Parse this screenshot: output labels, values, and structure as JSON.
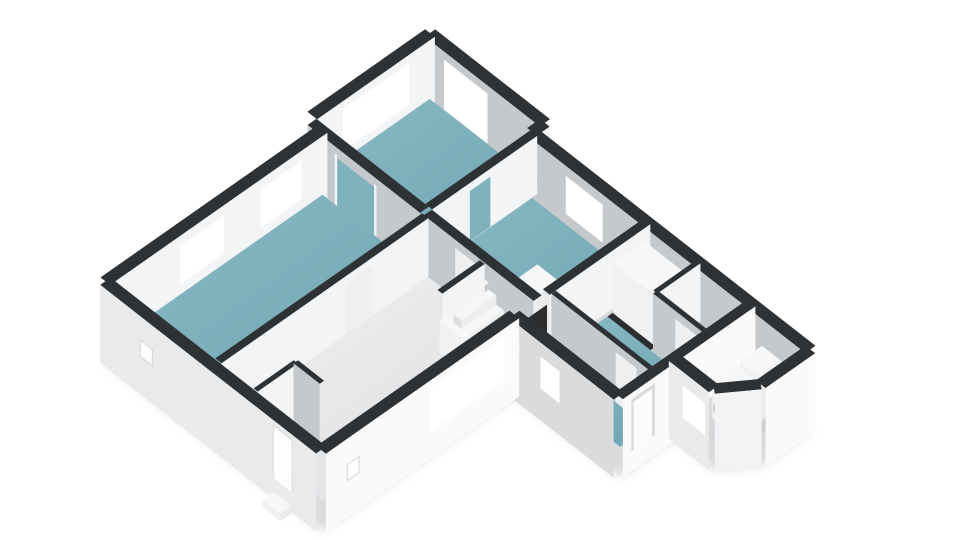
{
  "meta": {
    "title": "3D isometric floor plan, ground floor, no visible text",
    "background": "#ffffff",
    "view": "isometric-3d-floorplan"
  },
  "palette": {
    "band": "#2f3234",
    "intSW": "#c6c9cb",
    "intSE": "#f3f4f5",
    "extSW": "#e9eaec",
    "extSW2": "#d9dbdd",
    "extSE": "#fafafb",
    "chamfer": "#f2f3f5",
    "frame": "#ffffff",
    "glass": "#d8e7ec",
    "glassDoor": "#d2e2e8",
    "darkGap": "#2b2d2f",
    "doorgap": "#edeff0",
    "passage": "#7fb2bd",
    "tealA": "#8abac4",
    "tealB": "#6da5b2",
    "lightA": "#eff0f1",
    "lightB": "#dcdee1",
    "utilA": "#e9eaec",
    "utilB": "#c3c6ca",
    "boxTop": "#f6f7f8",
    "boxSW": "#f0f1f3",
    "boxSE": "#e8eaec",
    "stairTop": "#f5f6f7",
    "stairRiser": "#eceeef",
    "stairSide": "#dcdee0",
    "red": "#cb4334",
    "white": "#fcfdfd",
    "washerRing": "#c2c5c7",
    "washerFaceFill": "#eceef0",
    "washerHole": "#56595b",
    "shadow": "#8a9096"
  },
  "projection": {
    "ox": 430,
    "oy": 33,
    "ux": 34.8,
    "uy": 27.2,
    "vx": -36.8,
    "vy": 25.8,
    "floor": 58,
    "ground": 78
  },
  "shadow": {
    "outline": [
      [
        0,
        0
      ],
      [
        3.3,
        0
      ],
      [
        3.3,
        0.35
      ],
      [
        11.3,
        0.35
      ],
      [
        11.3,
        1.7
      ],
      [
        10.75,
        2.45
      ],
      [
        9.6,
        2.45
      ],
      [
        9.6,
        3.95
      ],
      [
        6.6,
        3.95
      ],
      [
        6.6,
        9.2
      ],
      [
        0.4,
        9.2
      ],
      [
        0.4,
        3.2
      ],
      [
        0,
        3.2
      ]
    ],
    "dz": 78,
    "dx": 1,
    "dy": 4,
    "opacity": 0.32,
    "blur": 5
  },
  "scene": [
    {
      "kind": "wall",
      "name": "kitchen-ne-wall",
      "from": [
        0,
        0
      ],
      "to": [
        3.3,
        0
      ],
      "t": 0.28,
      "ext": true,
      "face": "intSW",
      "openings": [
        {
          "type": "glassdoor",
          "a0": 0.55,
          "a1": 1.8,
          "z0": 8,
          "z1": 58
        }
      ]
    },
    {
      "kind": "wall",
      "name": "ne-step-wall",
      "from": [
        3.3,
        0
      ],
      "to": [
        3.3,
        0.35
      ],
      "t": 0.28,
      "ext": true,
      "face": "intSE"
    },
    {
      "kind": "wall",
      "name": "main-ne-wall",
      "from": [
        3.3,
        0.35
      ],
      "to": [
        11.3,
        0.35
      ],
      "t": 0.28,
      "ext": true,
      "face": "intSW",
      "openings": [
        {
          "type": "window",
          "a0": 4.42,
          "a1": 5.48,
          "z0": 10,
          "z1": 48,
          "cols": 2,
          "rows": 2
        },
        {
          "type": "window",
          "a0": 7.35,
          "a1": 7.85,
          "z0": 14,
          "z1": 42,
          "cols": 1,
          "rows": 1
        }
      ]
    },
    {
      "kind": "wall",
      "name": "kitchen-nw-wall",
      "from": [
        0,
        0
      ],
      "to": [
        0,
        3.2
      ],
      "t": 0.28,
      "ext": true,
      "face": "intSE",
      "openings": [
        {
          "type": "window",
          "a0": 0.7,
          "a1": 2.5,
          "z0": 8,
          "z1": 50,
          "cols": 2,
          "rows": 3
        }
      ]
    },
    {
      "kind": "floor",
      "name": "kitchen-floor",
      "fill": "gTeal",
      "poly": [
        [
          0.15,
          0.15
        ],
        [
          3.26,
          0.15
        ],
        [
          3.26,
          3.22
        ],
        [
          0.15,
          3.22
        ]
      ]
    },
    {
      "kind": "floor",
      "name": "middle-room-floor",
      "fill": "gTeal",
      "poly": [
        [
          3.46,
          0.5
        ],
        [
          6.52,
          0.5
        ],
        [
          6.52,
          3.25
        ],
        [
          3.46,
          3.25
        ]
      ]
    },
    {
      "kind": "wall",
      "name": "kitchen-middle-wall",
      "from": [
        3.35,
        0.35
      ],
      "to": [
        3.35,
        3.2
      ],
      "t": 0.2,
      "face": "intSE",
      "openings": [
        {
          "type": "passage",
          "a0": 1.55,
          "a1": 2.25,
          "z0": 8,
          "z1": 58
        }
      ]
    },
    {
      "kind": "box",
      "name": "middle-room-closet",
      "x0": 5.75,
      "y0": 2.52,
      "x1": 6.35,
      "y1": 3.08,
      "zTop": 10
    },
    {
      "kind": "wall",
      "name": "kitchen-living-wall",
      "from": [
        0.12,
        3.32
      ],
      "to": [
        3.35,
        3.32
      ],
      "t": 0.24,
      "face": "intSW",
      "openings": [
        {
          "type": "passage",
          "a0": 0.9,
          "a1": 2.1,
          "z0": 10,
          "z1": 58
        }
      ]
    },
    {
      "kind": "wall",
      "name": "living-nw-wall",
      "from": [
        0.4,
        3.3
      ],
      "to": [
        0.4,
        9.2
      ],
      "t": 0.28,
      "ext": true,
      "face": "intSE",
      "openings": [
        {
          "type": "window",
          "a0": 4.0,
          "a1": 5.1,
          "z0": 10,
          "z1": 48,
          "cols": 2,
          "rows": 2
        },
        {
          "type": "window",
          "a0": 6.1,
          "a1": 7.3,
          "z0": 10,
          "z1": 48,
          "cols": 2,
          "rows": 2
        }
      ]
    },
    {
      "kind": "wall",
      "name": "middle-hall-wall",
      "from": [
        3.45,
        3.32
      ],
      "to": [
        6.6,
        3.32
      ],
      "t": 0.22,
      "face": "intSW",
      "openings": [
        {
          "type": "doorgap",
          "a0": 4.35,
          "a1": 5.05,
          "z0": 8,
          "z1": 58
        }
      ]
    },
    {
      "kind": "floor",
      "name": "living-room-floor",
      "fill": "gTeal",
      "poly": [
        [
          0.55,
          3.44
        ],
        [
          3.42,
          3.44
        ],
        [
          3.42,
          9.04
        ],
        [
          0.55,
          9.04
        ]
      ]
    },
    {
      "kind": "floor",
      "name": "hallway-floor",
      "fill": "gLight",
      "poly": [
        [
          3.56,
          3.44
        ],
        [
          6.52,
          3.44
        ],
        [
          6.52,
          9.04
        ],
        [
          3.56,
          9.04
        ]
      ]
    },
    {
      "kind": "wall",
      "name": "living-hall-wall",
      "from": [
        3.48,
        3.42
      ],
      "to": [
        3.48,
        9.04
      ],
      "t": 0.18,
      "face": "intSE",
      "openings": [
        {
          "type": "doorgap",
          "a0": 4.95,
          "a1": 5.65,
          "z0": 8,
          "z1": 58
        }
      ]
    },
    {
      "kind": "wall",
      "name": "middle-se-wall",
      "from": [
        6.6,
        0.35
      ],
      "to": [
        6.6,
        3.08
      ],
      "t": 0.2,
      "face": "intSE"
    },
    {
      "kind": "facequad",
      "name": "hall-corridor-doorway",
      "axis": "v",
      "at": 6.66,
      "a0": 3.12,
      "a1": 3.78,
      "z0": 10,
      "z1": 58,
      "fill": "darkGap"
    },
    {
      "kind": "floor",
      "name": "bathroom-closet-floor",
      "fill": "#2c2e30",
      "poly": [
        [
          6.78,
          0.5
        ],
        [
          8.02,
          0.5
        ],
        [
          8.02,
          1.6
        ],
        [
          6.78,
          1.6
        ]
      ]
    },
    {
      "kind": "box",
      "name": "bathroom-closet",
      "x0": 6.8,
      "y0": 0.6,
      "x1": 7.95,
      "y1": 1.45,
      "zTop": 8
    },
    {
      "kind": "wall",
      "name": "toilet-west-wall",
      "from": [
        8.08,
        0.35
      ],
      "to": [
        8.08,
        1.52
      ],
      "t": 0.12,
      "face": "intSE"
    },
    {
      "kind": "floor",
      "name": "toilet-floor",
      "fill": "gLight",
      "poly": [
        [
          8.16,
          0.5
        ],
        [
          9.46,
          0.5
        ],
        [
          9.46,
          1.44
        ],
        [
          8.16,
          1.44
        ]
      ]
    },
    {
      "kind": "wall",
      "name": "toilet-south-wall",
      "from": [
        8.08,
        1.52
      ],
      "to": [
        9.52,
        1.52
      ],
      "t": 0.12,
      "face": "intSW",
      "openings": [
        {
          "type": "doorgap",
          "a0": 8.72,
          "a1": 9.32,
          "z0": 8,
          "z1": 58
        }
      ]
    },
    {
      "kind": "floor",
      "name": "bathroom-floor",
      "fill": "gTeal",
      "poly": [
        [
          6.78,
          1.59
        ],
        [
          9.46,
          1.59
        ],
        [
          9.46,
          2.9
        ],
        [
          6.78,
          2.9
        ]
      ]
    },
    {
      "kind": "wall",
      "name": "bathroom-corridor-wall",
      "from": [
        6.7,
        2.98
      ],
      "to": [
        9.52,
        2.98
      ],
      "t": 0.12,
      "face": "intSW",
      "openings": [
        {
          "type": "doorgap",
          "a0": 8.55,
          "a1": 9.15,
          "z0": 8,
          "z1": 58
        }
      ]
    },
    {
      "kind": "floor",
      "name": "corridor-floor",
      "fill": "gTeal",
      "poly": [
        [
          6.72,
          3.05
        ],
        [
          9.48,
          3.05
        ],
        [
          9.48,
          3.8
        ],
        [
          6.72,
          3.8
        ]
      ]
    },
    {
      "kind": "wall",
      "name": "utility-divider-wall",
      "from": [
        9.6,
        0.35
      ],
      "to": [
        9.6,
        3.95
      ],
      "t": 0.24,
      "ext": true,
      "face": "extSE",
      "openings": [
        {
          "type": "backdoor",
          "a0": 3.08,
          "a1": 3.72,
          "z0": 6,
          "z1": 58
        }
      ]
    },
    {
      "kind": "floor",
      "name": "utility-floor",
      "fill": "gUtil",
      "poly": [
        [
          9.74,
          0.5
        ],
        [
          11.14,
          0.5
        ],
        [
          11.14,
          1.74
        ],
        [
          10.66,
          2.34
        ],
        [
          9.74,
          2.34
        ]
      ]
    },
    {
      "kind": "box",
      "name": "utility-cabinet",
      "x0": 10.3,
      "y0": 0.72,
      "x1": 10.9,
      "y1": 1.32,
      "zTop": 14
    },
    {
      "kind": "box",
      "name": "washing-machine",
      "x0": 10.18,
      "y0": 1.3,
      "x1": 10.78,
      "y1": 1.95,
      "zTop": 22,
      "circle": true
    },
    {
      "kind": "wall",
      "name": "utility-sw-wall",
      "from": [
        9.6,
        2.45
      ],
      "to": [
        10.75,
        2.45
      ],
      "t": 0.28,
      "ext": true,
      "face": "extSW",
      "openings": [
        {
          "type": "louver",
          "a0": 10.0,
          "a1": 10.64,
          "z0": 14,
          "z1": 46
        }
      ]
    },
    {
      "kind": "wall",
      "name": "wing-chamfer-wall",
      "from": [
        10.75,
        2.45
      ],
      "to": [
        11.3,
        1.7
      ],
      "t": 0.28,
      "ext": true,
      "face": "chamfer"
    },
    {
      "kind": "wall",
      "name": "wing-se-wall",
      "from": [
        11.3,
        0.35
      ],
      "to": [
        11.3,
        1.7
      ],
      "t": 0.28,
      "ext": true,
      "face": "extSE"
    },
    {
      "kind": "wall",
      "name": "wing-sw-wall",
      "from": [
        6.6,
        3.95
      ],
      "to": [
        9.6,
        3.95
      ],
      "t": 0.28,
      "ext": true,
      "face": "extSW2",
      "openings": [
        {
          "type": "window",
          "a0": 7.5,
          "a1": 8.05,
          "z0": 14,
          "z1": 46,
          "cols": 1,
          "rows": 1
        }
      ]
    },
    {
      "kind": "wall",
      "name": "stairwell-wall",
      "from": [
        5.15,
        3.45
      ],
      "to": [
        5.15,
        4.6
      ],
      "t": 0.14,
      "face": "intSE"
    },
    {
      "kind": "stairs",
      "name": "staircase",
      "x_low": 6.32,
      "tread": 0.22,
      "count": 4,
      "y0": 3.55,
      "y1": 4.5,
      "z_first": 44,
      "z_step": 9,
      "cut_top": [
        5.26,
        5.45
      ]
    },
    {
      "kind": "box",
      "name": "stair-balustrade",
      "x0": 5.2,
      "y0": 4.5,
      "x1": 6.35,
      "y1": 4.66,
      "zTop": 26
    },
    {
      "kind": "wall",
      "name": "meter-closet-west-wall",
      "from": [
        4.55,
        7.95
      ],
      "to": [
        4.55,
        9.04
      ],
      "t": 0.12,
      "face": "intSE"
    },
    {
      "kind": "wall",
      "name": "meter-closet-north-wall",
      "from": [
        4.55,
        7.95
      ],
      "to": [
        5.3,
        7.95
      ],
      "t": 0.12,
      "face": "intSW"
    },
    {
      "kind": "box",
      "name": "meter-cabinet",
      "x0": 4.7,
      "y0": 8.5,
      "x1": 5.12,
      "y1": 8.95,
      "zTop": 32,
      "redStripe": true
    },
    {
      "kind": "wall",
      "name": "main-se-wall",
      "from": [
        6.6,
        3.95
      ],
      "to": [
        6.6,
        9.2
      ],
      "t": 0.28,
      "ext": true,
      "face": "extSE",
      "openings": [
        {
          "type": "window",
          "a0": 4.35,
          "a1": 6.35,
          "z0": 8,
          "z1": 52,
          "cols": 3,
          "rows": 3
        },
        {
          "type": "vent",
          "a0": 8.3,
          "a1": 8.62,
          "z0": 26,
          "z1": 42
        }
      ]
    },
    {
      "kind": "wall",
      "name": "sw-facade-wall",
      "from": [
        0.4,
        9.2
      ],
      "to": [
        6.6,
        9.2
      ],
      "t": 0.28,
      "ext": true,
      "face": "extSW",
      "openings": [
        {
          "type": "vent",
          "a0": 1.55,
          "a1": 1.9,
          "z0": 24,
          "z1": 40
        },
        {
          "type": "door",
          "a0": 5.35,
          "a1": 5.95,
          "z0": 4,
          "z1": 58
        }
      ]
    },
    {
      "kind": "box",
      "name": "front-door-step",
      "x0": 5.4,
      "y0": 9.36,
      "x1": 5.92,
      "y1": 9.66,
      "zTop": 70,
      "zBot": 78
    }
  ]
}
